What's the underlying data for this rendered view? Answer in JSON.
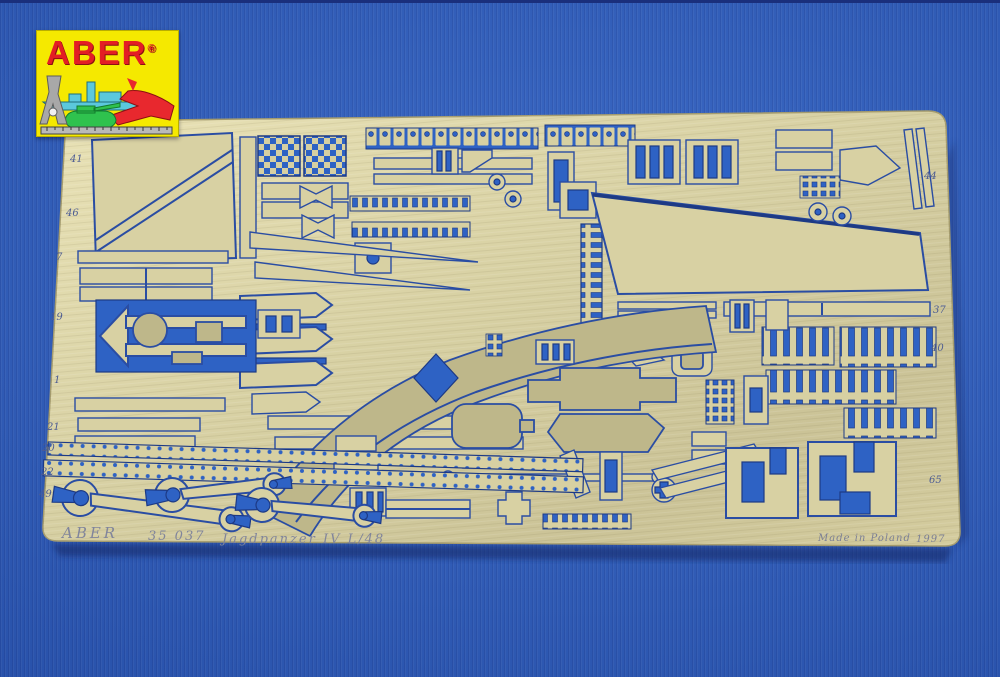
{
  "logo": {
    "brand": "ABER",
    "registered_mark": "®",
    "background_color": "#f5e900",
    "brand_color": "#e31e24",
    "icons": [
      "battleship-icon",
      "fighter-jet-icon",
      "tank-icon",
      "caliper-icon",
      "ruler-icon"
    ]
  },
  "fret": {
    "markings": {
      "manufacturer": "ABER",
      "catalog_number": "35 037",
      "subject": "Jagdpanzer IV L/48",
      "origin": "Made in Poland",
      "year": "1997"
    },
    "part_numbers": [
      "41",
      "46",
      "7",
      "19",
      "1",
      "21",
      "20",
      "22",
      "49",
      "44",
      "37",
      "40",
      "65"
    ],
    "colors": {
      "brass": "#d8d1a3",
      "brass_semi_etched": "#beb78a",
      "cutout_blue": "#2e62c4",
      "outline_navy": "#1d3a85"
    }
  },
  "background": {
    "fabric_color": "#2d5fc2",
    "top_edge_color": "#1a2f7c"
  }
}
